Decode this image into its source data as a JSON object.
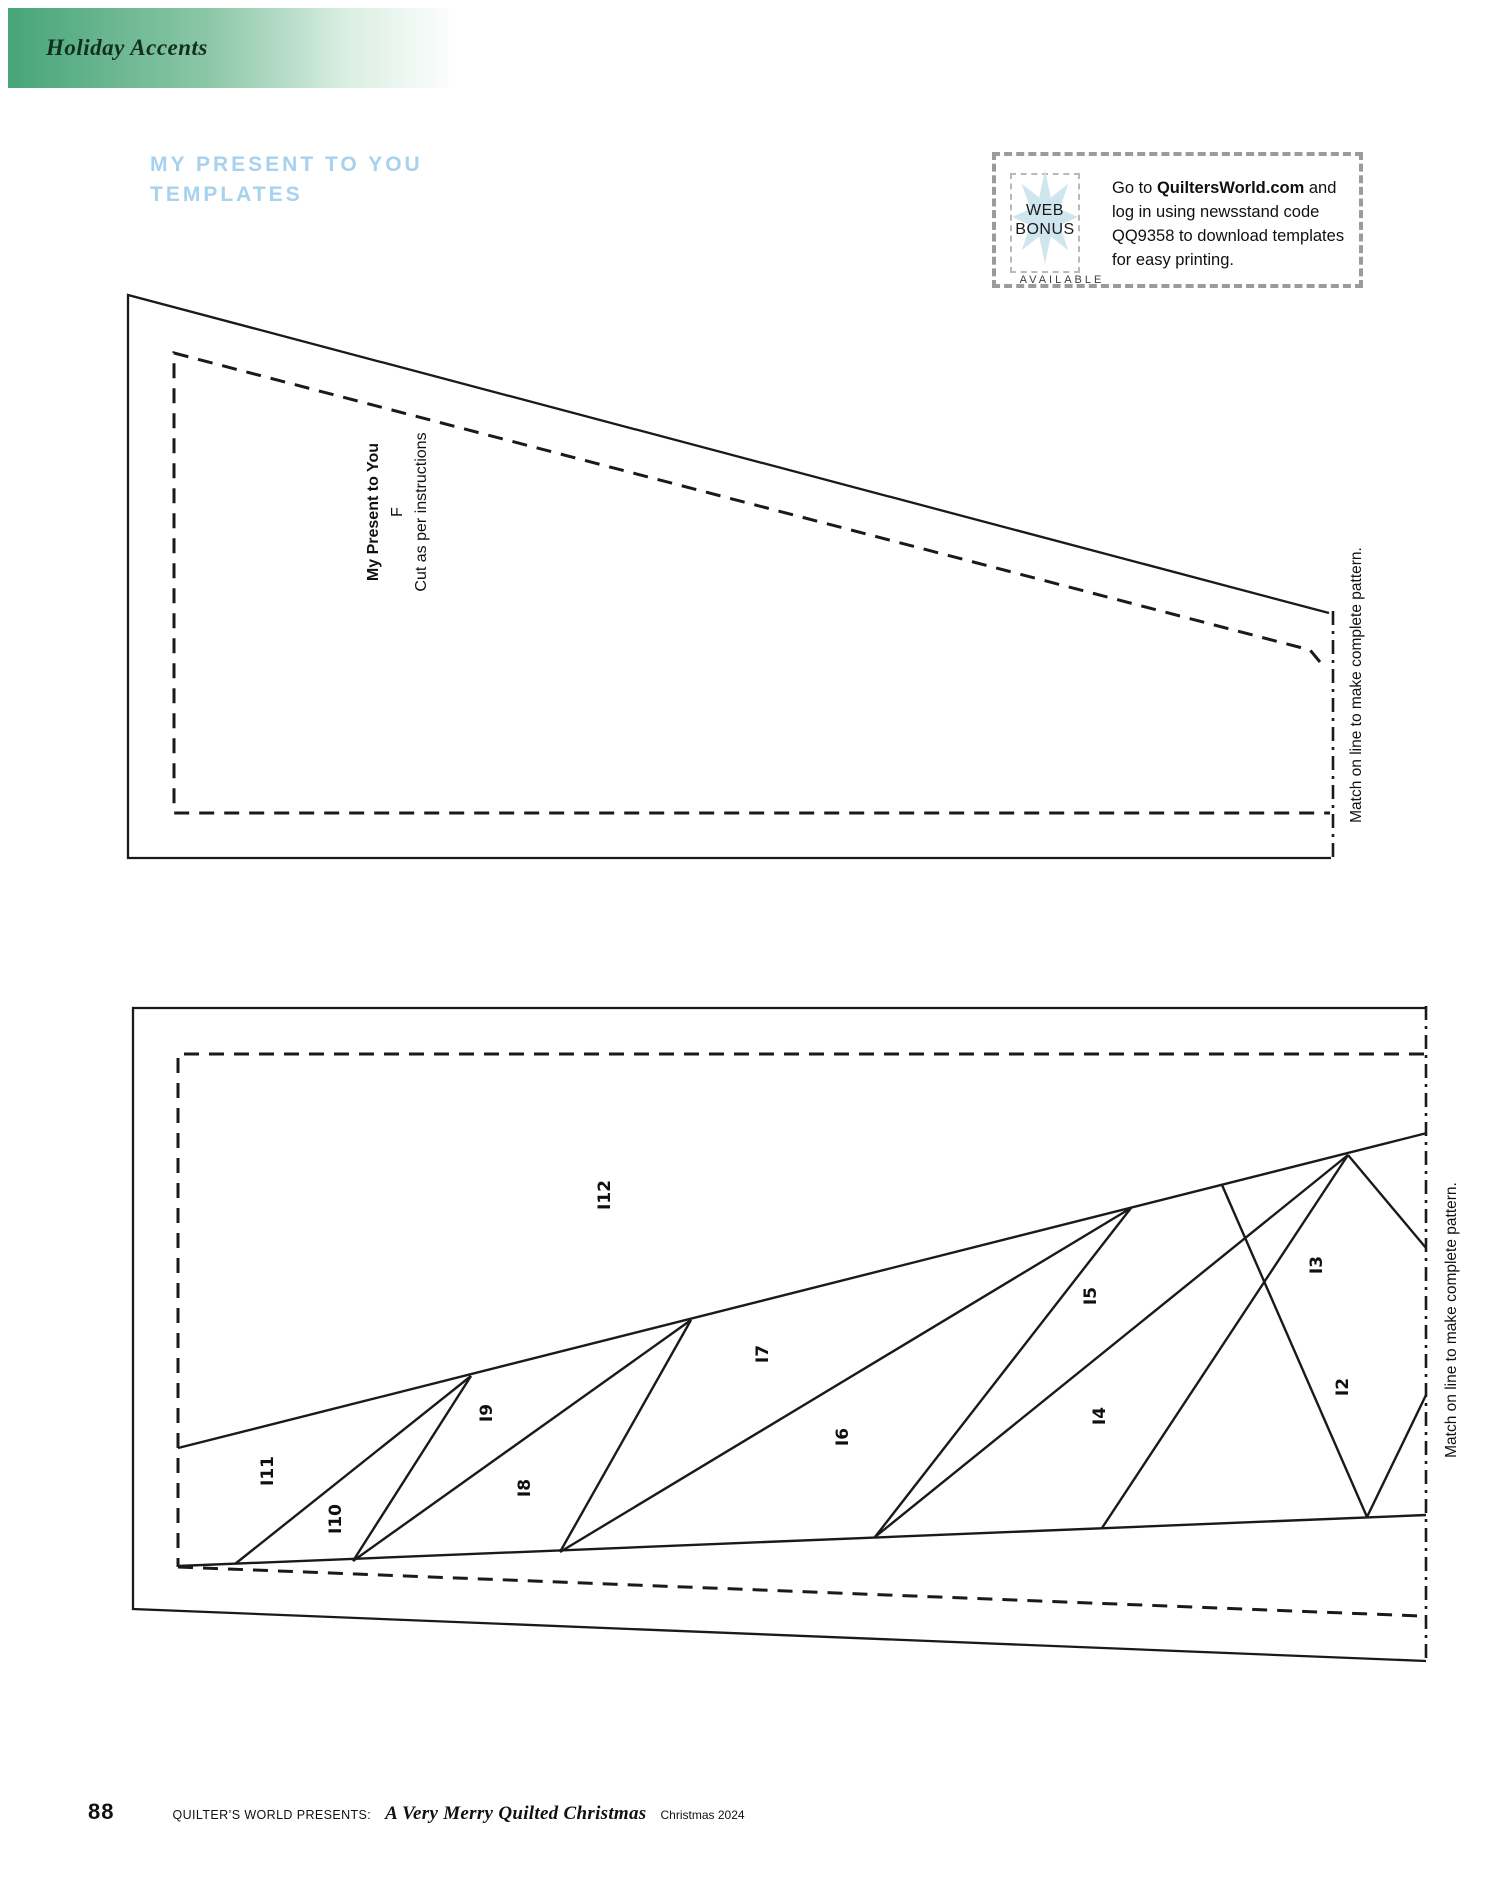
{
  "header": {
    "section": "Holiday Accents"
  },
  "title": {
    "line1": "MY PRESENT TO YOU",
    "line2": "TEMPLATES"
  },
  "web_bonus": {
    "badge_line1": "WEB",
    "badge_line2": "BONUS",
    "available": "AVAILABLE",
    "go_to": "Go to ",
    "site": "QuiltersWorld.com",
    "rest": " and log in using newsstand code QQ9358 to download templates for easy printing.",
    "star_icon": "quilt-star-icon"
  },
  "top_template": {
    "name_label": "My Present to You",
    "piece_letter": "F",
    "cut_note": "Cut as per instructions",
    "match_text": "Match on line to make complete pattern."
  },
  "bottom_template": {
    "match_text": "Match on line to make complete pattern.",
    "pieces": [
      "I2",
      "I3",
      "I4",
      "I5",
      "I6",
      "I7",
      "I8",
      "I9",
      "I10",
      "I11",
      "I12"
    ]
  },
  "footer": {
    "page_number": "88",
    "presents": "QUILTER’S WORLD PRESENTS:",
    "book_title": "A Very Merry Quilted Christmas",
    "edition": "Christmas 2024"
  },
  "colors": {
    "header_green": "#47a578",
    "title_blue": "#a6d2ee",
    "line_black": "#1a1a1a",
    "star_blue": "#cfe6ee",
    "dash_gray": "#9b9b9b"
  }
}
